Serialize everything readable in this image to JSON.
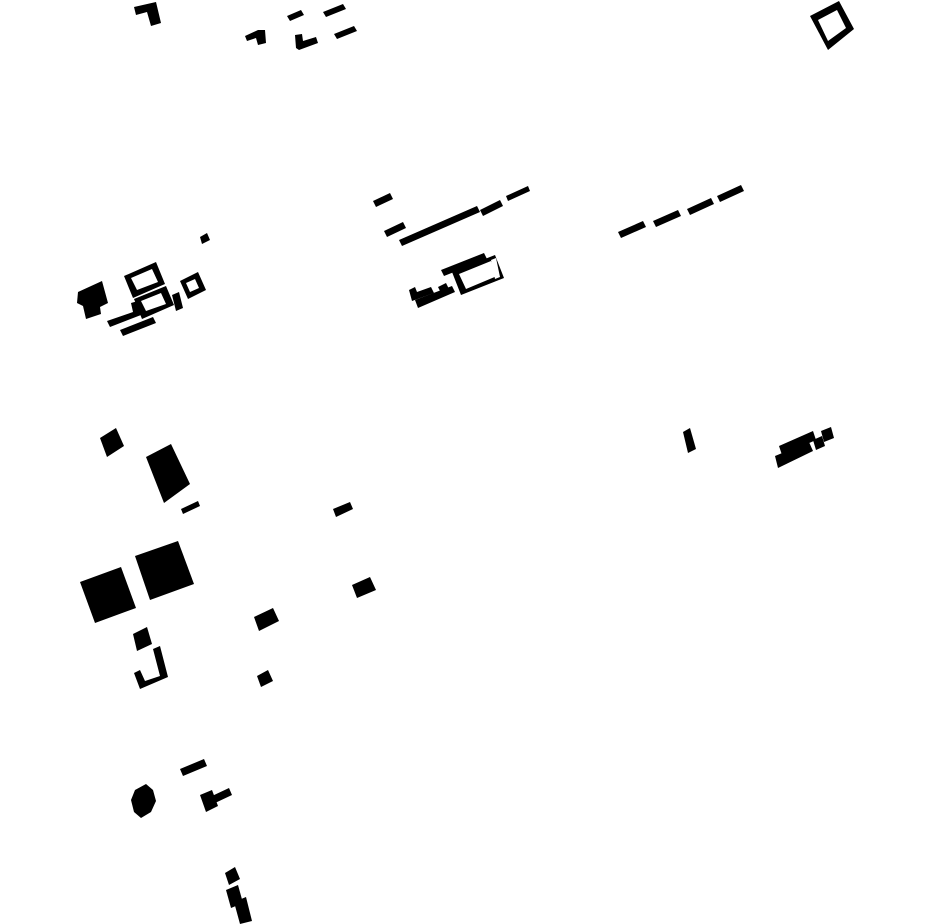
{
  "canvas": {
    "width": 930,
    "height": 924,
    "background_color": "#ffffff",
    "ink_color": "#000000",
    "content": "figure-ground building footprint map, black polygons on white, tilted about -20 degrees"
  },
  "shapes": [
    {
      "name": "building-bracket-nw",
      "points": [
        [
          134,
          7
        ],
        [
          156,
          2
        ],
        [
          161,
          23
        ],
        [
          151,
          26
        ],
        [
          147,
          12
        ],
        [
          136,
          15
        ]
      ]
    },
    {
      "name": "building-hook-n",
      "points": [
        [
          245,
          36
        ],
        [
          258,
          30
        ],
        [
          265,
          30
        ],
        [
          266,
          43
        ],
        [
          258,
          45
        ],
        [
          256,
          38
        ],
        [
          247,
          41
        ]
      ]
    },
    {
      "name": "building-dash-n1",
      "points": [
        [
          287,
          16
        ],
        [
          301,
          10
        ],
        [
          304,
          15
        ],
        [
          290,
          21
        ]
      ]
    },
    {
      "name": "building-dash-n2",
      "points": [
        [
          323,
          12
        ],
        [
          343,
          4
        ],
        [
          346,
          9
        ],
        [
          326,
          17
        ]
      ]
    },
    {
      "name": "building-bracket-n",
      "points": [
        [
          295,
          35
        ],
        [
          302,
          34
        ],
        [
          303,
          41
        ],
        [
          316,
          37
        ],
        [
          318,
          43
        ],
        [
          299,
          50
        ],
        [
          296,
          48
        ]
      ]
    },
    {
      "name": "building-dash-n3",
      "points": [
        [
          334,
          34
        ],
        [
          354,
          26
        ],
        [
          357,
          31
        ],
        [
          337,
          39
        ]
      ]
    },
    {
      "name": "building-ring-ne",
      "points": [
        [
          810,
          16
        ],
        [
          839,
          1
        ],
        [
          854,
          29
        ],
        [
          828,
          50
        ]
      ],
      "hole": [
        [
          818,
          20
        ],
        [
          837,
          10
        ],
        [
          846,
          28
        ],
        [
          828,
          41
        ]
      ]
    },
    {
      "name": "building-ring-ne-gap",
      "fill": "#ffffff",
      "points": [
        [
          812,
          37
        ],
        [
          819,
          33
        ],
        [
          823,
          43
        ],
        [
          816,
          47
        ]
      ]
    },
    {
      "name": "dash-road-w1",
      "points": [
        [
          373,
          201
        ],
        [
          390,
          193
        ],
        [
          393,
          199
        ],
        [
          376,
          207
        ]
      ]
    },
    {
      "name": "dash-road-w2",
      "points": [
        [
          384,
          231
        ],
        [
          403,
          222
        ],
        [
          406,
          228
        ],
        [
          387,
          237
        ]
      ]
    },
    {
      "name": "dash-road-long",
      "points": [
        [
          399,
          240
        ],
        [
          477,
          206
        ],
        [
          480,
          212
        ],
        [
          402,
          246
        ]
      ]
    },
    {
      "name": "dash-road-w3",
      "points": [
        [
          480,
          210
        ],
        [
          500,
          200
        ],
        [
          503,
          206
        ],
        [
          483,
          216
        ]
      ]
    },
    {
      "name": "dash-road-w4",
      "points": [
        [
          506,
          196
        ],
        [
          528,
          186
        ],
        [
          530,
          191
        ],
        [
          508,
          201
        ]
      ]
    },
    {
      "name": "dash-road-e1",
      "points": [
        [
          618,
          232
        ],
        [
          643,
          221
        ],
        [
          646,
          227
        ],
        [
          621,
          238
        ]
      ]
    },
    {
      "name": "dash-road-e2",
      "points": [
        [
          653,
          221
        ],
        [
          678,
          210
        ],
        [
          681,
          216
        ],
        [
          656,
          227
        ]
      ]
    },
    {
      "name": "dash-road-e3",
      "points": [
        [
          687,
          209
        ],
        [
          711,
          198
        ],
        [
          714,
          204
        ],
        [
          690,
          215
        ]
      ]
    },
    {
      "name": "dash-road-e4",
      "points": [
        [
          717,
          196
        ],
        [
          741,
          185
        ],
        [
          744,
          191
        ],
        [
          720,
          202
        ]
      ]
    },
    {
      "name": "building-dot-n",
      "points": [
        [
          200,
          237
        ],
        [
          207,
          233
        ],
        [
          210,
          240
        ],
        [
          202,
          244
        ]
      ]
    },
    {
      "name": "building-blob-w",
      "points": [
        [
          78,
          292
        ],
        [
          102,
          281
        ],
        [
          108,
          303
        ],
        [
          100,
          307
        ],
        [
          101,
          314
        ],
        [
          86,
          319
        ],
        [
          83,
          306
        ],
        [
          77,
          303
        ]
      ]
    },
    {
      "name": "building-ring-w1",
      "points": [
        [
          124,
          276
        ],
        [
          156,
          262
        ],
        [
          165,
          284
        ],
        [
          133,
          298
        ]
      ],
      "hole": [
        [
          131,
          278
        ],
        [
          152,
          269
        ],
        [
          158,
          282
        ],
        [
          137,
          290
        ]
      ]
    },
    {
      "name": "building-ring-w2",
      "points": [
        [
          134,
          299
        ],
        [
          166,
          286
        ],
        [
          174,
          305
        ],
        [
          142,
          319
        ]
      ],
      "hole": [
        [
          141,
          301
        ],
        [
          161,
          293
        ],
        [
          166,
          304
        ],
        [
          146,
          311
        ]
      ]
    },
    {
      "name": "building-ring-w3",
      "points": [
        [
          180,
          281
        ],
        [
          198,
          272
        ],
        [
          206,
          290
        ],
        [
          188,
          299
        ]
      ],
      "hole": [
        [
          186,
          283
        ],
        [
          195,
          279
        ],
        [
          199,
          288
        ],
        [
          190,
          292
        ]
      ]
    },
    {
      "name": "building-lbar-w",
      "points": [
        [
          131,
          303
        ],
        [
          138,
          301
        ],
        [
          141,
          315
        ],
        [
          110,
          327
        ],
        [
          107,
          321
        ],
        [
          133,
          312
        ]
      ]
    },
    {
      "name": "building-bar-w",
      "points": [
        [
          120,
          330
        ],
        [
          153,
          317
        ],
        [
          156,
          323
        ],
        [
          123,
          336
        ]
      ]
    },
    {
      "name": "building-vdash-w",
      "points": [
        [
          172,
          295
        ],
        [
          179,
          292
        ],
        [
          183,
          308
        ],
        [
          176,
          311
        ]
      ]
    },
    {
      "name": "building-bar-c1",
      "points": [
        [
          441,
          270
        ],
        [
          484,
          253
        ],
        [
          487,
          259
        ],
        [
          444,
          276
        ]
      ]
    },
    {
      "name": "building-ring-c",
      "points": [
        [
          452,
          272
        ],
        [
          495,
          255
        ],
        [
          504,
          278
        ],
        [
          461,
          295
        ]
      ],
      "hole": [
        [
          459,
          274
        ],
        [
          491,
          261
        ],
        [
          497,
          276
        ],
        [
          466,
          289
        ]
      ]
    },
    {
      "name": "building-ring-c-gap",
      "fill": "#ffffff",
      "points": [
        [
          491,
          260
        ],
        [
          496,
          258
        ],
        [
          500,
          277
        ],
        [
          495,
          279
        ]
      ]
    },
    {
      "name": "building-lbracket-c",
      "points": [
        [
          409,
          290
        ],
        [
          415,
          287
        ],
        [
          417,
          292
        ],
        [
          431,
          287
        ],
        [
          434,
          293
        ],
        [
          412,
          301
        ]
      ]
    },
    {
      "name": "building-dash-c1",
      "points": [
        [
          438,
          287
        ],
        [
          446,
          283
        ],
        [
          449,
          289
        ],
        [
          441,
          293
        ]
      ]
    },
    {
      "name": "building-bar-c2",
      "points": [
        [
          415,
          300
        ],
        [
          452,
          286
        ],
        [
          455,
          292
        ],
        [
          418,
          308
        ]
      ]
    },
    {
      "name": "building-square-sw1",
      "points": [
        [
          100,
          438
        ],
        [
          116,
          428
        ],
        [
          124,
          446
        ],
        [
          107,
          457
        ]
      ]
    },
    {
      "name": "building-rect-sw",
      "points": [
        [
          146,
          457
        ],
        [
          171,
          444
        ],
        [
          190,
          484
        ],
        [
          164,
          503
        ]
      ]
    },
    {
      "name": "building-dash-sw1",
      "points": [
        [
          181,
          509
        ],
        [
          198,
          501
        ],
        [
          200,
          506
        ],
        [
          183,
          514
        ]
      ]
    },
    {
      "name": "building-bigsquare-1",
      "points": [
        [
          80,
          582
        ],
        [
          121,
          567
        ],
        [
          136,
          608
        ],
        [
          95,
          623
        ]
      ]
    },
    {
      "name": "building-bigsquare-2",
      "points": [
        [
          135,
          556
        ],
        [
          178,
          541
        ],
        [
          194,
          584
        ],
        [
          150,
          600
        ]
      ]
    },
    {
      "name": "building-quad-sw",
      "points": [
        [
          133,
          634
        ],
        [
          147,
          627
        ],
        [
          152,
          644
        ],
        [
          137,
          651
        ]
      ]
    },
    {
      "name": "building-jbracket-sw",
      "points": [
        [
          153,
          649
        ],
        [
          160,
          646
        ],
        [
          168,
          677
        ],
        [
          140,
          689
        ],
        [
          134,
          673
        ],
        [
          140,
          670
        ],
        [
          145,
          681
        ],
        [
          160,
          676
        ]
      ]
    },
    {
      "name": "building-dash-c2",
      "points": [
        [
          333,
          509
        ],
        [
          350,
          502
        ],
        [
          353,
          509
        ],
        [
          336,
          517
        ]
      ]
    },
    {
      "name": "building-rect-s1",
      "points": [
        [
          352,
          585
        ],
        [
          370,
          577
        ],
        [
          376,
          590
        ],
        [
          357,
          598
        ]
      ]
    },
    {
      "name": "building-rect-s2",
      "points": [
        [
          254,
          617
        ],
        [
          273,
          608
        ],
        [
          279,
          621
        ],
        [
          259,
          631
        ]
      ]
    },
    {
      "name": "building-square-s",
      "points": [
        [
          257,
          676
        ],
        [
          268,
          670
        ],
        [
          273,
          681
        ],
        [
          261,
          687
        ]
      ]
    },
    {
      "name": "building-tick-e",
      "points": [
        [
          683,
          432
        ],
        [
          690,
          428
        ],
        [
          696,
          449
        ],
        [
          688,
          453
        ]
      ]
    },
    {
      "name": "building-bar-e1",
      "points": [
        [
          779,
          446
        ],
        [
          813,
          431
        ],
        [
          816,
          440
        ],
        [
          782,
          455
        ]
      ]
    },
    {
      "name": "building-bar-e2",
      "points": [
        [
          775,
          456
        ],
        [
          809,
          442
        ],
        [
          813,
          451
        ],
        [
          778,
          468
        ]
      ]
    },
    {
      "name": "building-square-e1",
      "points": [
        [
          813,
          440
        ],
        [
          822,
          436
        ],
        [
          825,
          446
        ],
        [
          816,
          450
        ]
      ]
    },
    {
      "name": "building-square-e2",
      "points": [
        [
          821,
          431
        ],
        [
          831,
          427
        ],
        [
          834,
          438
        ],
        [
          824,
          442
        ]
      ]
    },
    {
      "name": "building-blob-s",
      "points": [
        [
          135,
          790
        ],
        [
          146,
          784
        ],
        [
          153,
          790
        ],
        [
          156,
          801
        ],
        [
          151,
          812
        ],
        [
          141,
          818
        ],
        [
          134,
          812
        ],
        [
          131,
          800
        ]
      ]
    },
    {
      "name": "building-dash-s",
      "points": [
        [
          180,
          769
        ],
        [
          204,
          759
        ],
        [
          207,
          766
        ],
        [
          183,
          776
        ]
      ]
    },
    {
      "name": "building-bar-s",
      "points": [
        [
          212,
          796
        ],
        [
          229,
          788
        ],
        [
          232,
          795
        ],
        [
          215,
          803
        ]
      ]
    },
    {
      "name": "building-block-s",
      "points": [
        [
          200,
          795
        ],
        [
          212,
          790
        ],
        [
          218,
          806
        ],
        [
          206,
          812
        ]
      ]
    },
    {
      "name": "building-square-bottom",
      "points": [
        [
          225,
          873
        ],
        [
          235,
          867
        ],
        [
          240,
          879
        ],
        [
          229,
          885
        ]
      ]
    },
    {
      "name": "building-z-upper",
      "points": [
        [
          226,
          890
        ],
        [
          238,
          885
        ],
        [
          243,
          903
        ],
        [
          231,
          908
        ]
      ]
    },
    {
      "name": "building-z-lower",
      "points": [
        [
          234,
          902
        ],
        [
          246,
          897
        ],
        [
          252,
          921
        ],
        [
          240,
          924
        ]
      ]
    }
  ]
}
